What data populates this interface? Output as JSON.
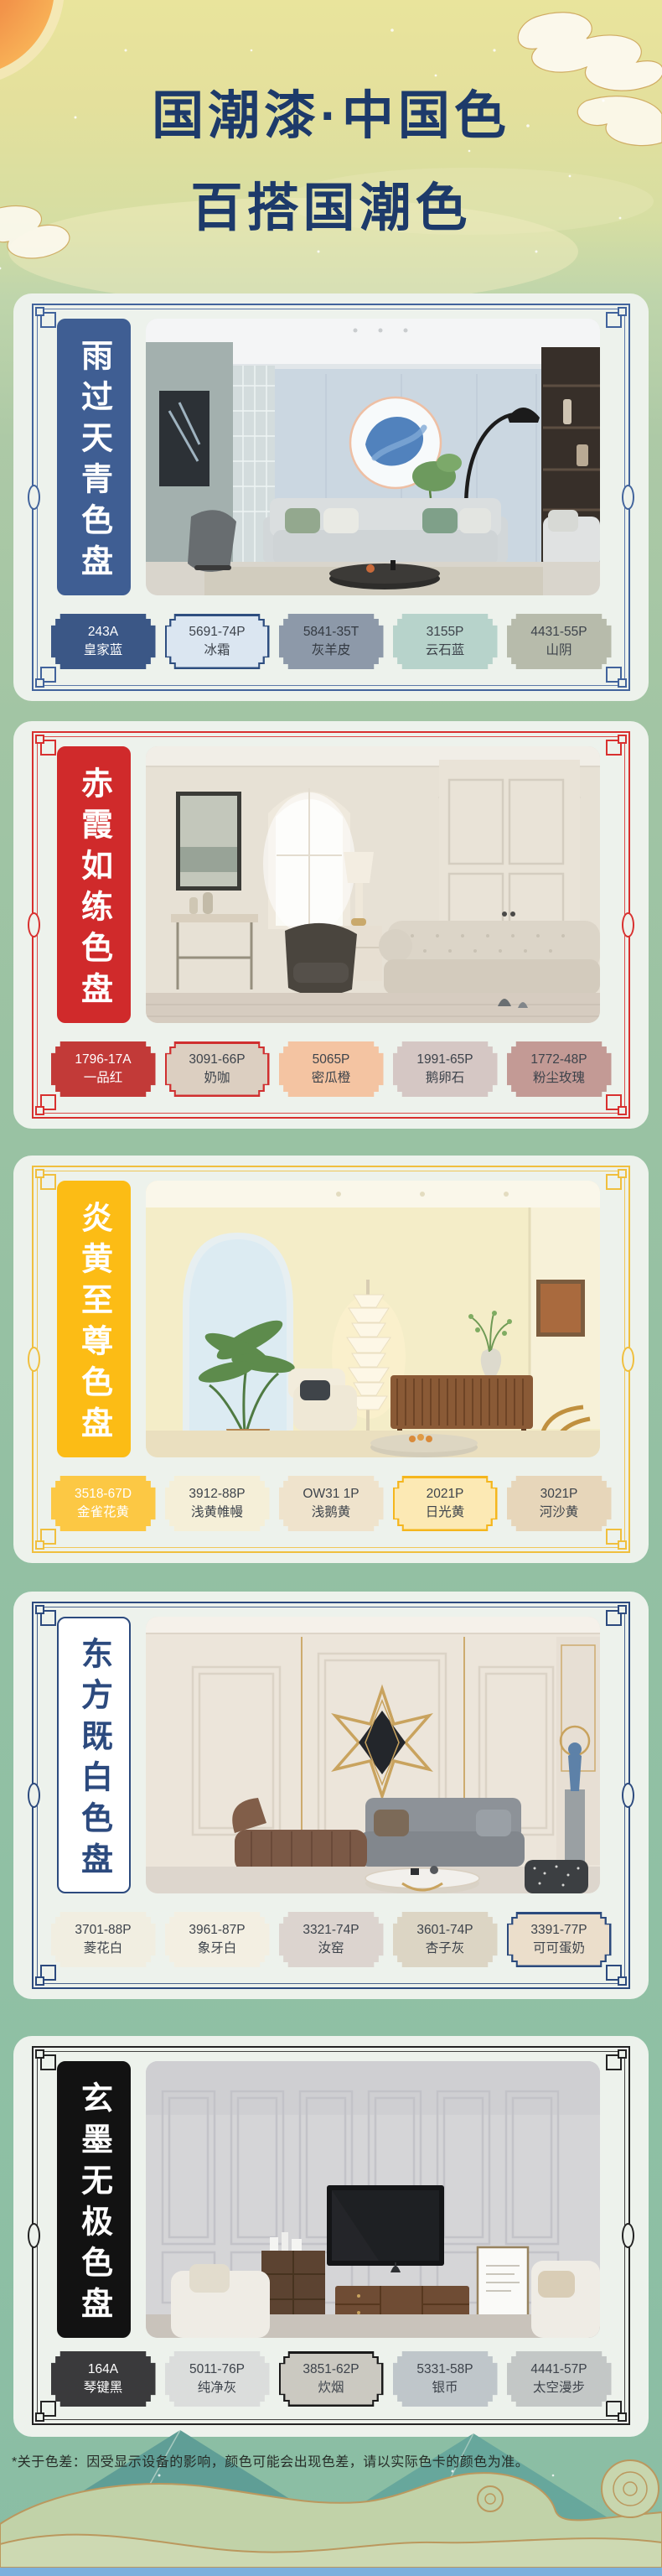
{
  "header": {
    "title_line1": "国潮漆·中国色",
    "title_line2": "百搭国潮色",
    "title_color": "#1d3a6a"
  },
  "footer": {
    "disclaimer": "*关于色差：因受显示设备的影响，颜色可能会出现色差，请以实际色卡的颜色为准。",
    "bottom_bar_color": "#7bb0dd"
  },
  "palettes": [
    {
      "title": "雨过天青色盘",
      "theme": "#41639c",
      "banner_bg": "#3f5e93",
      "banner_fg": "#ffffff",
      "banner_border": "#3f5e93",
      "swatches": [
        {
          "code": "243A",
          "name": "皇家蓝",
          "bg": "#3b5786",
          "fg": "#ffffff",
          "ring": "#3b5786"
        },
        {
          "code": "5691-74P",
          "name": "冰霜",
          "bg": "#dbe6f1",
          "fg": "#3d434b",
          "ring": "#2e4e80"
        },
        {
          "code": "5841-35T",
          "name": "灰羊皮",
          "bg": "#8d99a9",
          "fg": "#343a42",
          "ring": "#8d99a9"
        },
        {
          "code": "3155P",
          "name": "云石蓝",
          "bg": "#b7d3cb",
          "fg": "#3d434b",
          "ring": "#b7d3cb"
        },
        {
          "code": "4431-55P",
          "name": "山阴",
          "bg": "#b7bbab",
          "fg": "#3d434b",
          "ring": "#b7bbab"
        }
      ]
    },
    {
      "title": "赤霞如练色盘",
      "theme": "#d8302f",
      "banner_bg": "#d02a2b",
      "banner_fg": "#ffffff",
      "banner_border": "#d02a2b",
      "swatches": [
        {
          "code": "1796-17A",
          "name": "一品红",
          "bg": "#c23a38",
          "fg": "#ffffff",
          "ring": "#c23a38"
        },
        {
          "code": "3091-66P",
          "name": "奶咖",
          "bg": "#dccfc1",
          "fg": "#3d434b",
          "ring": "#d02f2f"
        },
        {
          "code": "5065P",
          "name": "密瓜橙",
          "bg": "#f4c4a2",
          "fg": "#3d434b",
          "ring": "#f4c4a2"
        },
        {
          "code": "1991-65P",
          "name": "鹅卵石",
          "bg": "#d5c7c4",
          "fg": "#3d434b",
          "ring": "#d5c7c4"
        },
        {
          "code": "1772-48P",
          "name": "粉尘玫瑰",
          "bg": "#c39a95",
          "fg": "#3d434b",
          "ring": "#c39a95"
        }
      ]
    },
    {
      "title": "炎黄至尊色盘",
      "theme": "#f0bf3e",
      "banner_bg": "#fcbc15",
      "banner_fg": "#ffffff",
      "banner_border": "#fcbc15",
      "swatches": [
        {
          "code": "3518-67D",
          "name": "金雀花黄",
          "bg": "#fcc844",
          "fg": "#ffffff",
          "ring": "#fcc844"
        },
        {
          "code": "3912-88P",
          "name": "浅黄帷幔",
          "bg": "#f5efd8",
          "fg": "#3d434b",
          "ring": "#f5efd8"
        },
        {
          "code": "OW31 1P",
          "name": "浅鹅黄",
          "bg": "#efe3cc",
          "fg": "#3d434b",
          "ring": "#efe3cc"
        },
        {
          "code": "2021P",
          "name": "日光黄",
          "bg": "#fce9b4",
          "fg": "#3d434b",
          "ring": "#f5b61d"
        },
        {
          "code": "3021P",
          "name": "河沙黄",
          "bg": "#e7d6ba",
          "fg": "#3d434b",
          "ring": "#e7d6ba"
        }
      ]
    },
    {
      "title": "东方既白色盘",
      "theme": "#2c4a7e",
      "banner_bg": "#ffffff",
      "banner_fg": "#2c4a7e",
      "banner_border": "#2c4a7e",
      "swatches": [
        {
          "code": "3701-88P",
          "name": "菱花白",
          "bg": "#f1eee1",
          "fg": "#3d434b",
          "ring": "#f1eee1"
        },
        {
          "code": "3961-87P",
          "name": "象牙白",
          "bg": "#f3efe2",
          "fg": "#3d434b",
          "ring": "#f3efe2"
        },
        {
          "code": "3321-74P",
          "name": "汝窑",
          "bg": "#dcd4cf",
          "fg": "#3d434b",
          "ring": "#dcd4cf"
        },
        {
          "code": "3601-74P",
          "name": "杏子灰",
          "bg": "#dcd5c4",
          "fg": "#3d434b",
          "ring": "#dcd5c4"
        },
        {
          "code": "3391-77P",
          "name": "可可蛋奶",
          "bg": "#ebdecb",
          "fg": "#3d434b",
          "ring": "#2b4a7d"
        }
      ]
    },
    {
      "title": "玄墨无极色盘",
      "theme": "#232323",
      "banner_bg": "#121212",
      "banner_fg": "#ffffff",
      "banner_border": "#121212",
      "swatches": [
        {
          "code": "164A",
          "name": "琴键黑",
          "bg": "#3a3a3c",
          "fg": "#ffffff",
          "ring": "#3a3a3c"
        },
        {
          "code": "5011-76P",
          "name": "纯净灰",
          "bg": "#dbdddc",
          "fg": "#3d434b",
          "ring": "#dbdddc"
        },
        {
          "code": "3851-62P",
          "name": "炊烟",
          "bg": "#cbc9c1",
          "fg": "#3d434b",
          "ring": "#1a1a1a"
        },
        {
          "code": "5331-58P",
          "name": "银币",
          "bg": "#bfc6ca",
          "fg": "#3d434b",
          "ring": "#bfc6ca"
        },
        {
          "code": "4441-57P",
          "name": "太空漫步",
          "bg": "#c3c7c6",
          "fg": "#3d434b",
          "ring": "#c3c7c6"
        }
      ]
    }
  ]
}
